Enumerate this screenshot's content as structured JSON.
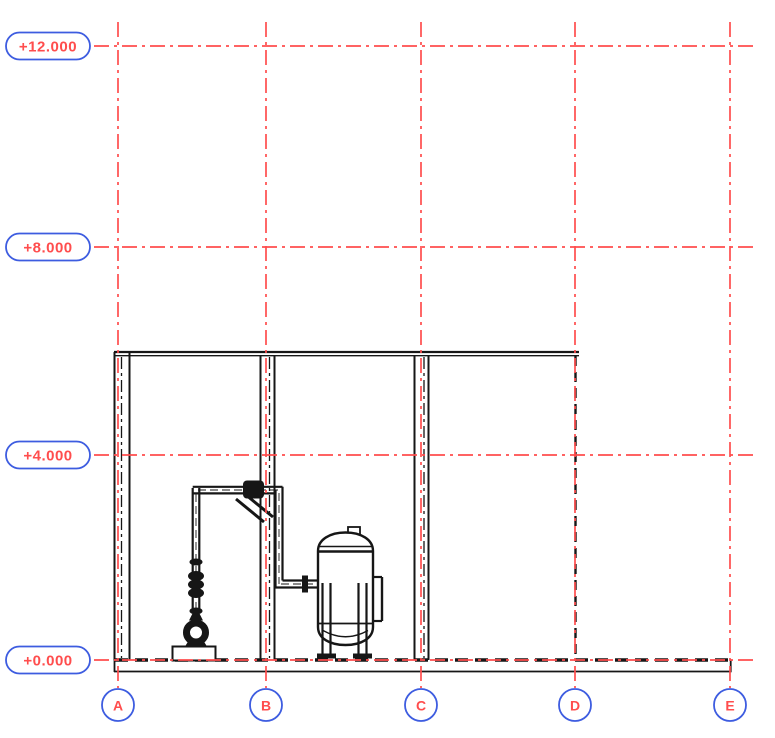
{
  "drawing": {
    "kind": "cad-elevation-view",
    "colors": {
      "grid_line": "#ff4d4d",
      "marker_border": "#3d5ce0",
      "marker_text": "#ff4d4d",
      "geometry_line": "#161616",
      "background": "#ffffff"
    },
    "grid": {
      "columns": [
        {
          "label": "A",
          "x": 118
        },
        {
          "label": "B",
          "x": 266
        },
        {
          "label": "C",
          "x": 421
        },
        {
          "label": "D",
          "x": 575
        },
        {
          "label": "E",
          "x": 730
        }
      ],
      "column_line_top": 22,
      "column_line_bottom": 688,
      "bubble_cy": 705,
      "bubble_r": 16,
      "levels": [
        {
          "label": "+12.000",
          "y": 46
        },
        {
          "label": "+8.000",
          "y": 247
        },
        {
          "label": "+4.000",
          "y": 455
        },
        {
          "label": "+0.000",
          "y": 660
        }
      ],
      "level_line_left": 94,
      "level_line_right": 757,
      "capsule": {
        "x": 6,
        "width": 84,
        "height": 27,
        "radius": 13.5
      }
    },
    "equipment": [
      {
        "name": "centrifugal-pump-with-vertical-discharge-piping"
      },
      {
        "name": "vertical-vessel-on-legs"
      }
    ],
    "structure": [
      {
        "name": "roof-line-span",
        "from_column": "A",
        "to_column": "D"
      },
      {
        "name": "walls-at-columns",
        "columns": [
          "A",
          "B",
          "C"
        ]
      },
      {
        "name": "hidden-wall",
        "column": "D"
      },
      {
        "name": "floor-slab",
        "from_column": "A",
        "to_column": "E",
        "level": "+0.000"
      }
    ]
  }
}
